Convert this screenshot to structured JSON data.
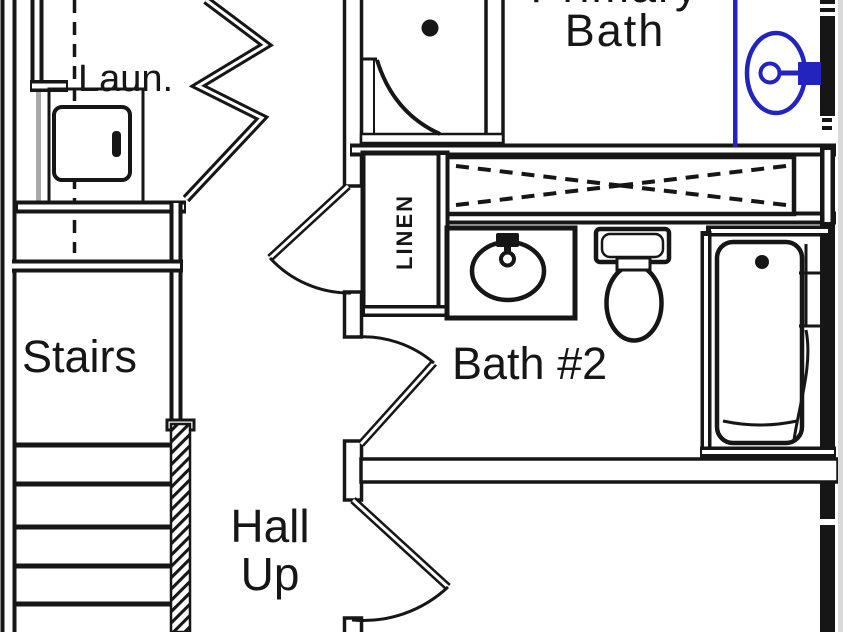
{
  "drawing_type": "floor-plan",
  "colors": {
    "ink": "#161616",
    "plumbing_highlight_blue": "#2323bd"
  },
  "rooms": {
    "laundry": {
      "label": "Laun."
    },
    "stairs": {
      "label": "Stairs"
    },
    "hall": {
      "label_line1": "Hall",
      "label_line2": "Up"
    },
    "linen_closet": {
      "label": "LINEN"
    },
    "bath_2": {
      "label": "Bath #2"
    },
    "primary_bath": {
      "label_line1": "Primary",
      "label_line2": "Bath"
    }
  },
  "fixtures": {
    "laundry": [
      "washer-dryer"
    ],
    "primary_bath": [
      "shower-stall",
      "round-pedestal-sink-blue"
    ],
    "bath_2": [
      "vanity-sink",
      "toilet",
      "bathtub"
    ],
    "closets": [
      "wire-shelf-closet",
      "linen-closet"
    ]
  },
  "doors": [
    "laundry-bifold-door",
    "linen-closet-door",
    "bath-2-door",
    "bedroom-door"
  ]
}
